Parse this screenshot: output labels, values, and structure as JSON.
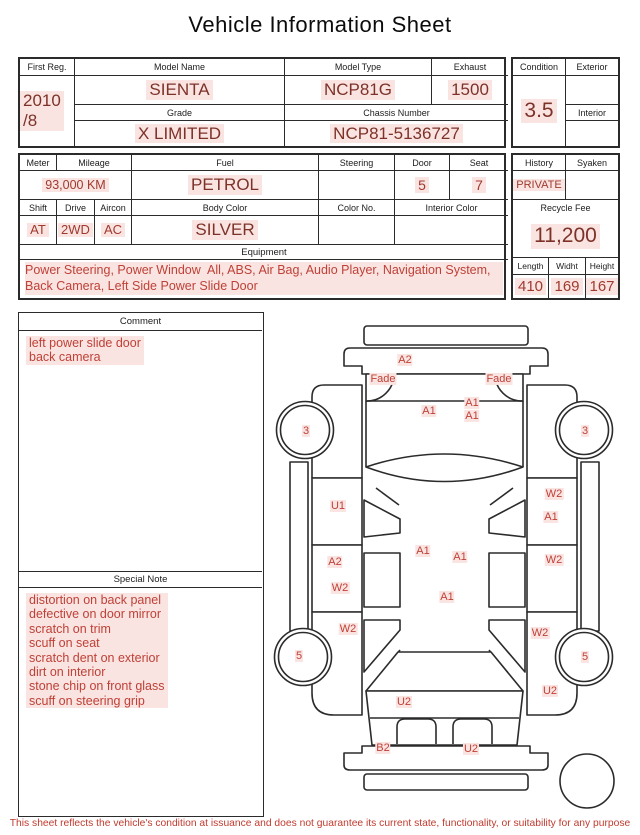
{
  "title": "Vehicle Information Sheet",
  "colors": {
    "value_red": "#7d3228",
    "small_value_red": "#a03a2e",
    "notes_red": "#bf4036",
    "highlight_pink": "#fae4e2",
    "line": "#2b2b2b"
  },
  "info": {
    "first_reg": {
      "label": "First Reg.",
      "value": "2010\n/8"
    },
    "model_name": {
      "label": "Model Name",
      "value": "SIENTA"
    },
    "model_type": {
      "label": "Model Type",
      "value": "NCP81G"
    },
    "exhaust": {
      "label": "Exhaust",
      "value": "1500"
    },
    "grade": {
      "label": "Grade",
      "value": "X LIMITED"
    },
    "chassis_number": {
      "label": "Chassis Number",
      "value": "NCP81-5136727"
    },
    "condition": {
      "label": "Condition",
      "value": "3.5"
    },
    "exterior": {
      "label": "Exterior",
      "value": ""
    },
    "interior": {
      "label": "Interior",
      "value": ""
    },
    "meter": {
      "label": "Meter"
    },
    "mileage": {
      "label": "Mileage",
      "value": "93,000 KM"
    },
    "fuel": {
      "label": "Fuel",
      "value": "PETROL"
    },
    "steering": {
      "label": "Steering",
      "value": ""
    },
    "door": {
      "label": "Door",
      "value": "5"
    },
    "seat": {
      "label": "Seat",
      "value": "7"
    },
    "shift": {
      "label": "Shift",
      "value": "AT"
    },
    "drive": {
      "label": "Drive",
      "value": "2WD"
    },
    "aircon": {
      "label": "Aircon",
      "value": "AC"
    },
    "body_color": {
      "label": "Body Color",
      "value": "SILVER"
    },
    "color_no": {
      "label": "Color No.",
      "value": ""
    },
    "interior_color": {
      "label": "Interior Color",
      "value": ""
    },
    "history": {
      "label": "History",
      "value": "PRIVATE"
    },
    "syaken": {
      "label": "Syaken",
      "value": ""
    },
    "recycle_fee": {
      "label": "Recycle Fee",
      "value": "11,200"
    },
    "length": {
      "label": "Length",
      "value": "410"
    },
    "widht": {
      "label": "Widht",
      "value": "169"
    },
    "height": {
      "label": "Height",
      "value": "167"
    }
  },
  "equipment": {
    "header": "Equipment",
    "text": "Power Steering, Power Window  All, ABS, Air Bag, Audio Player, Navigation System, Back Camera, Left Side Power Slide Door"
  },
  "comment": {
    "header": "Comment",
    "text": "left power slide door\nback camera"
  },
  "special_note": {
    "header": "Special Note",
    "text": "distortion on back panel\ndefective on door mirror\nscratch on trim\nscuff on seat\nscratch dent on exterior\ndirt on interior\nstone chip on front glass\nscuff on steering grip"
  },
  "disclaimer": "This sheet reflects the vehicle's condition at issuance and does not guarantee its current state, functionality, or suitability for any purpose",
  "diagram": {
    "view": "top-expanded-vehicle-damage-map",
    "labels": [
      {
        "t": "A2",
        "x": 405,
        "y": 360
      },
      {
        "t": "Fade",
        "x": 383,
        "y": 379
      },
      {
        "t": "Fade",
        "x": 499,
        "y": 379
      },
      {
        "t": "A1",
        "x": 429,
        "y": 411
      },
      {
        "t": "A1",
        "x": 472,
        "y": 403
      },
      {
        "t": "A1",
        "x": 472,
        "y": 416
      },
      {
        "t": "3",
        "x": 306,
        "y": 431
      },
      {
        "t": "3",
        "x": 585,
        "y": 431
      },
      {
        "t": "U1",
        "x": 338,
        "y": 506
      },
      {
        "t": "W2",
        "x": 554,
        "y": 494
      },
      {
        "t": "A1",
        "x": 551,
        "y": 517
      },
      {
        "t": "A2",
        "x": 335,
        "y": 562
      },
      {
        "t": "W2",
        "x": 340,
        "y": 588
      },
      {
        "t": "A1",
        "x": 423,
        "y": 551
      },
      {
        "t": "A1",
        "x": 460,
        "y": 557
      },
      {
        "t": "A1",
        "x": 447,
        "y": 597
      },
      {
        "t": "W2",
        "x": 554,
        "y": 560
      },
      {
        "t": "W2",
        "x": 348,
        "y": 629
      },
      {
        "t": "W2",
        "x": 540,
        "y": 633
      },
      {
        "t": "5",
        "x": 299,
        "y": 656
      },
      {
        "t": "5",
        "x": 585,
        "y": 657
      },
      {
        "t": "U2",
        "x": 550,
        "y": 691
      },
      {
        "t": "U2",
        "x": 404,
        "y": 702
      },
      {
        "t": "B2",
        "x": 383,
        "y": 748
      },
      {
        "t": "U2",
        "x": 471,
        "y": 749
      }
    ]
  }
}
